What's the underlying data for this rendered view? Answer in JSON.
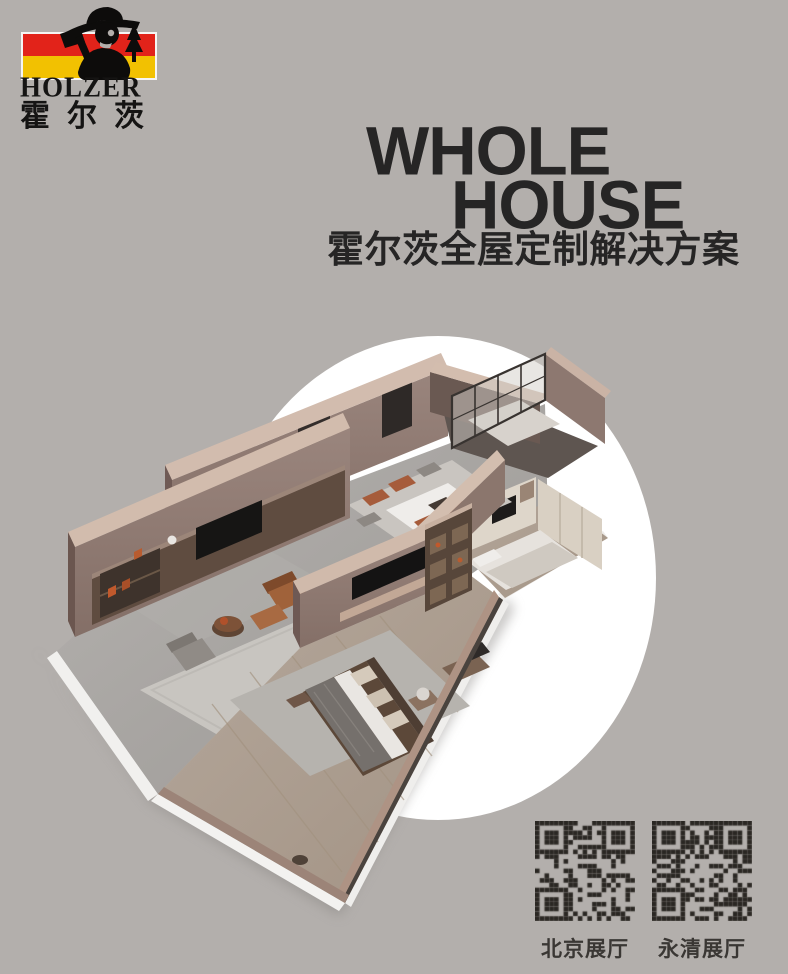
{
  "page": {
    "background": "#b3afac"
  },
  "logo": {
    "brand_en": "HOLZER",
    "brand_cn": "霍尔茨",
    "flag_red": "#e2231a",
    "flag_yellow": "#f2c101",
    "figure_icon": "lumberjack-icon"
  },
  "hero": {
    "title_line1": "WHOLE",
    "title_line2": "HOUSE",
    "subtitle": "霍尔茨全屋定制解决方案",
    "title_color": "#262525"
  },
  "scene": {
    "description": "isometric 3D render of whole-house custom apartment on white circle",
    "circle_color": "#ffffff"
  },
  "qr": {
    "module_color": "#2a2723",
    "items": [
      {
        "label": "北京展厅"
      },
      {
        "label": "永清展厅"
      }
    ]
  }
}
